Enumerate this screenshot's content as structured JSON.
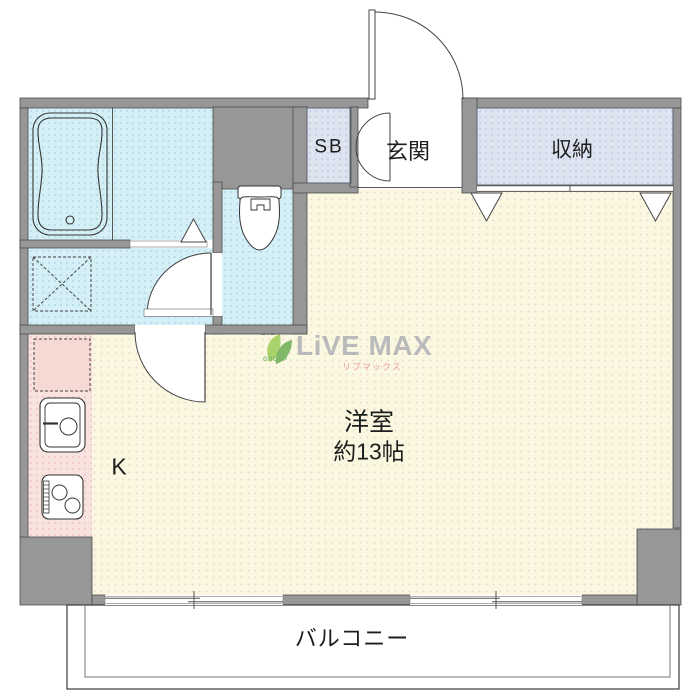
{
  "plan": {
    "labels": {
      "shoe_box": "SB",
      "entrance": "玄関",
      "storage": "収納",
      "main_room": "洋室",
      "main_room_size": "約13帖",
      "kitchen": "K",
      "balcony": "バルコニー"
    },
    "watermark": {
      "logo_top": "LIVE",
      "logo_bottom": "GROUP",
      "brand": "LiVE MAX",
      "brand_kana": "リブマックス"
    },
    "colors": {
      "wall": "#979797",
      "wet_area": "#d4f0f6",
      "living_room": "#fbf8e1",
      "kitchen": "#f9e3df",
      "closet": "#dde4f0",
      "balcony": "#ffffff",
      "linework": "#3a3a3a",
      "watermark_text": "#949aa6",
      "watermark_green": "#55a33c",
      "watermark_pink": "#e27ba1"
    },
    "icons": [
      "bathtub-icon",
      "washing-machine-pan-icon",
      "toilet-icon",
      "refrigerator-space-icon",
      "sink-icon",
      "stove-icon",
      "front-door-swing-icon",
      "double-door-icon",
      "door-swing-icon",
      "opening-triangle-icon",
      "sliding-window-icon",
      "closet-sliding-track",
      "watermark-leaf-logo-icon"
    ]
  }
}
